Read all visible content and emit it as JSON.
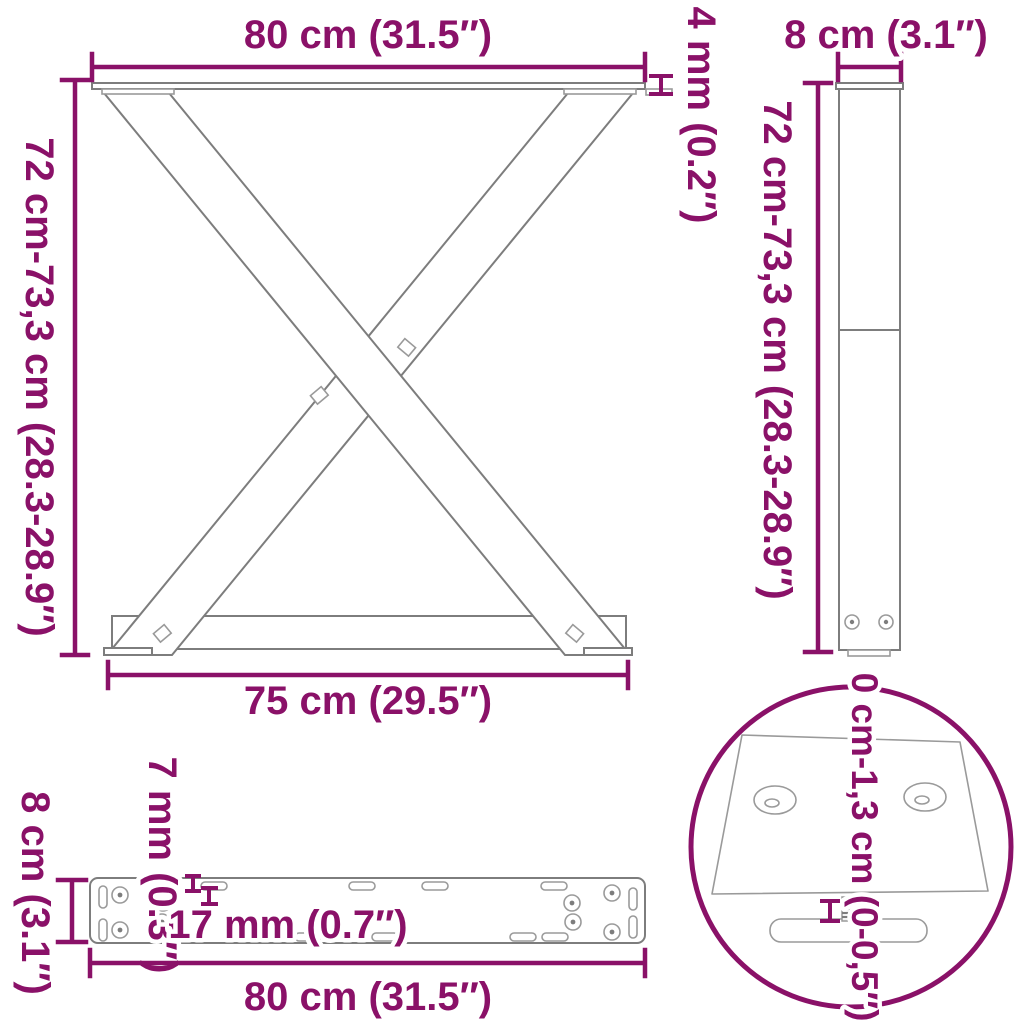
{
  "colors": {
    "accent": "#8A1168",
    "line": "#7d7d7d"
  },
  "views": {
    "front": {
      "width_top": "80 cm (31.5″)",
      "plate_thickness": "4 mm (0.2″)",
      "height": "72 cm-73,3 cm (28.3-28.9″)",
      "width_bottom": "75 cm (29.5″)"
    },
    "side": {
      "depth": "8 cm (3.1″)",
      "height": "72 cm-73,3 cm (28.3-28.9″)"
    },
    "plate": {
      "depth": "8 cm (3.1″)",
      "hole_small": "7 mm (0.3″)",
      "hole_large": "17 mm (0.7″)",
      "width": "80 cm (31.5″)"
    },
    "detail": {
      "adjustable_height": "0 cm-1,3 cm (0-0,5″)"
    }
  }
}
